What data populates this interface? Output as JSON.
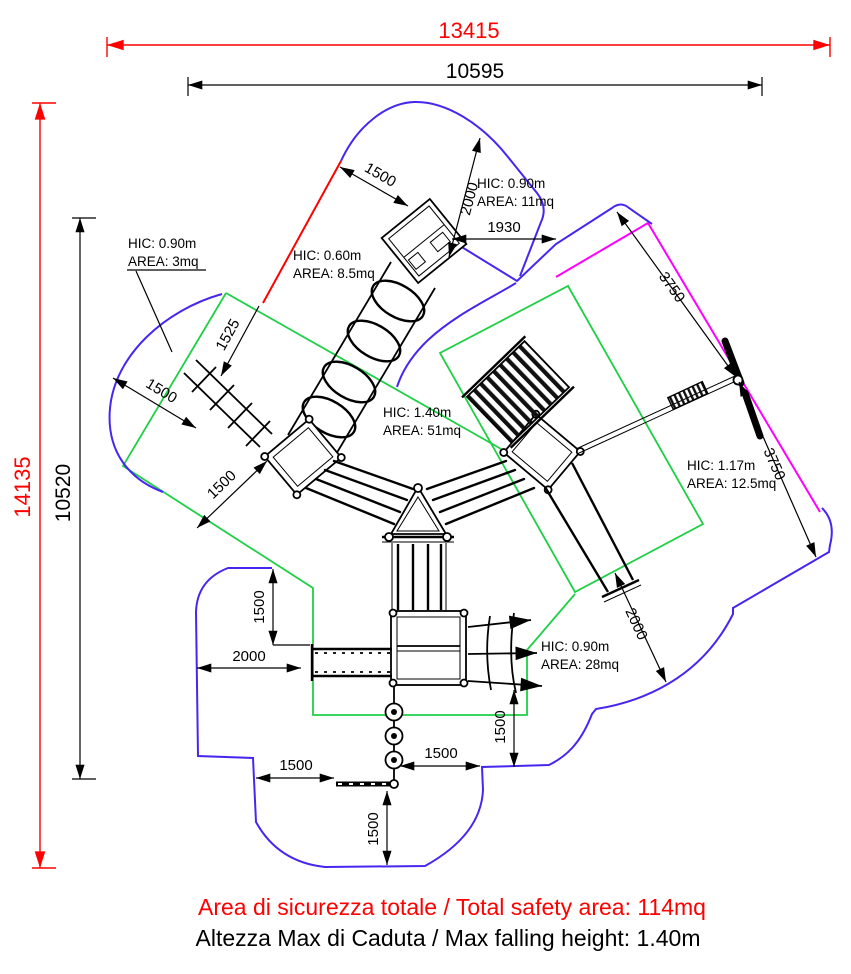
{
  "drawing": {
    "summary": {
      "total_safety_area": "Area di sicurezza totale / Total safety area: 114mq",
      "max_falling_height": "Altezza Max di Caduta / Max falling height: 1.40m"
    },
    "overall_dimensions": {
      "outer_width": "13415",
      "inner_width": "10595",
      "outer_height": "14135",
      "inner_height": "10520"
    },
    "detail_dimensions": {
      "tube_top_width": "1500",
      "tube_top_clearance": "2000",
      "gap_top_right": "1930",
      "tube_side": "1525",
      "left_zone_edge": "1500",
      "zipline_upper": "3750",
      "zipline_lower": "3750",
      "left_bridge": "1500",
      "left_inset_vertical": "1500",
      "left_inset_horizontal": "2000",
      "right_slide_exit": "2000",
      "net_side_vertical": "1500",
      "pods_to_edge": "1500",
      "beam_to_edge": "1500",
      "pods_bottom": "1500"
    },
    "hic_labels": [
      {
        "hic": "HIC: 0.90m",
        "area": "AREA: 3mq"
      },
      {
        "hic": "HIC: 0.60m",
        "area": "AREA: 8.5mq"
      },
      {
        "hic": "HIC: 0.90m",
        "area": "AREA: 11mq"
      },
      {
        "hic": "HIC: 1.40m",
        "area": "AREA: 51mq"
      },
      {
        "hic": "HIC: 1.17m",
        "area": "AREA: 12.5mq"
      },
      {
        "hic": "HIC: 0.90m",
        "area": "AREA: 28mq"
      }
    ],
    "colors": {
      "safety_outline": "#4527f0",
      "impact_zone": "#1fcf45",
      "zipline_zone": "#ff00ff",
      "critical_dimension": "#ff0000",
      "equipment": "#000000"
    }
  }
}
